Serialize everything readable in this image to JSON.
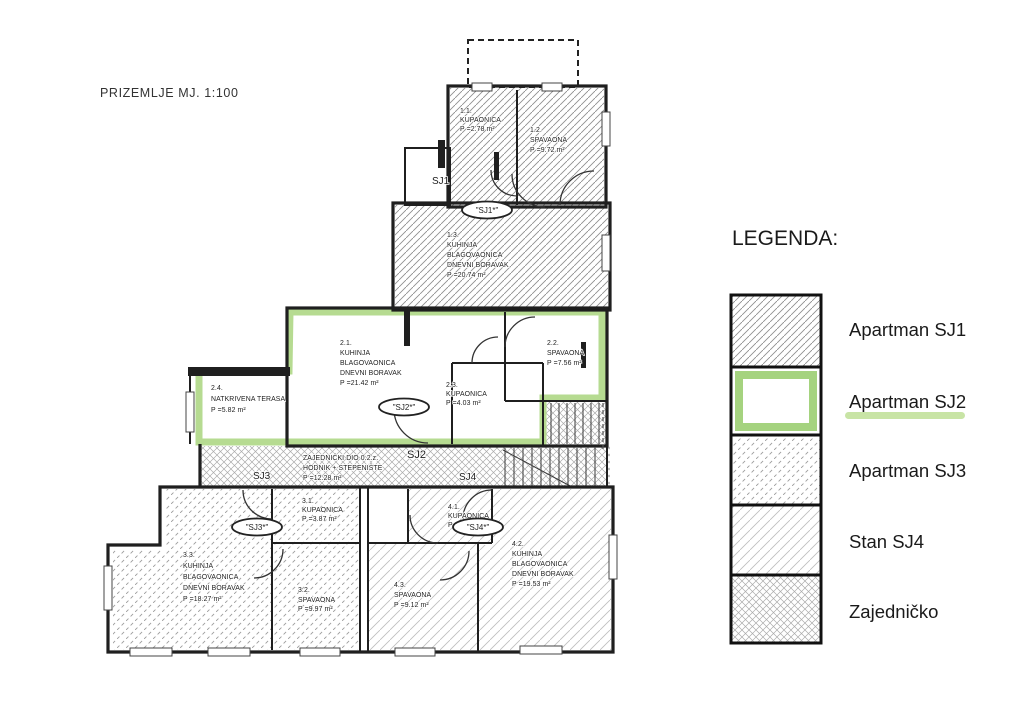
{
  "title": "PRIZEMLJE  MJ. 1:100",
  "colors": {
    "highlight_green": "#b2d98b",
    "legend_green": "#a5d37f",
    "underline_green": "#c8e4a5"
  },
  "rooms": {
    "r11": {
      "num": "1.1.",
      "lines": [
        "KUPAONICA"
      ],
      "area": "P =2.78 m²"
    },
    "r12": {
      "num": "1.2.",
      "lines": [
        "SPAVAONA"
      ],
      "area": "P =9.72 m²"
    },
    "r13": {
      "num": "1.3.",
      "lines": [
        "KUHINJA",
        "BLAGOVAONICA",
        "DNEVNI BORAVAK"
      ],
      "area": "P =20.74 m²"
    },
    "r21": {
      "num": "2.1.",
      "lines": [
        "KUHINJA",
        "BLAGOVAONICA",
        "DNEVNI BORAVAK"
      ],
      "area": "P =21.42 m²"
    },
    "r22": {
      "num": "2.2.",
      "lines": [
        "SPAVAONA"
      ],
      "area": "P =7.56 m²"
    },
    "r23": {
      "num": "2.3.",
      "lines": [
        "KUPAONICA"
      ],
      "area": "P =4.03 m²"
    },
    "r24": {
      "num": "2.4.",
      "lines": [
        "NATKRIVENA TERASA"
      ],
      "area": "P =5.82 m²"
    },
    "common": {
      "num": "",
      "lines": [
        "ZAJEDNIČKI DIO 0.2.z.",
        "HODNIK + STEPENIŠTE"
      ],
      "area": "P =12.28 m²"
    },
    "r31": {
      "num": "3.1.",
      "lines": [
        "KUPAONICA"
      ],
      "area": "P =3.87 m²"
    },
    "r32": {
      "num": "3.2.",
      "lines": [
        "SPAVAONA"
      ],
      "area": "P =9.97 m²"
    },
    "r33": {
      "num": "3.3.",
      "lines": [
        "KUHINJA",
        "BLAGOVAONICA",
        "DNEVNI BORAVAK"
      ],
      "area": "P =18.27 m²"
    },
    "r41": {
      "num": "4.1.",
      "lines": [
        "KUPAONICA"
      ],
      "area": "P =3.87 m²"
    },
    "r42": {
      "num": "4.2.",
      "lines": [
        "KUHINJA",
        "BLAGOVAONICA",
        "DNEVNI BORAVAK"
      ],
      "area": "P =19.53 m²"
    },
    "r43": {
      "num": "4.3.",
      "lines": [
        "SPAVAONA"
      ],
      "area": "P =9.12 m²"
    }
  },
  "tags": {
    "sj1": "SJ1",
    "sj2": "SJ2",
    "sj3": "SJ3",
    "sj4": "SJ4"
  },
  "stamps": {
    "sj1": "\"SJ1*\"",
    "sj2": "\"SJ2*\"",
    "sj3": "\"SJ3*\"",
    "sj4": "\"SJ4*\""
  },
  "legend": {
    "heading": "LEGENDA:",
    "items": [
      {
        "label": "Apartman SJ1",
        "pattern": "diagonal-hatch"
      },
      {
        "label": "Apartman SJ2",
        "pattern": "green-outline"
      },
      {
        "label": "Apartman SJ3",
        "pattern": "dashed-diagonal-hatch"
      },
      {
        "label": "Stan SJ4",
        "pattern": "light-diagonal-hatch"
      },
      {
        "label": "Zajedničko",
        "pattern": "crosshatch"
      }
    ]
  }
}
